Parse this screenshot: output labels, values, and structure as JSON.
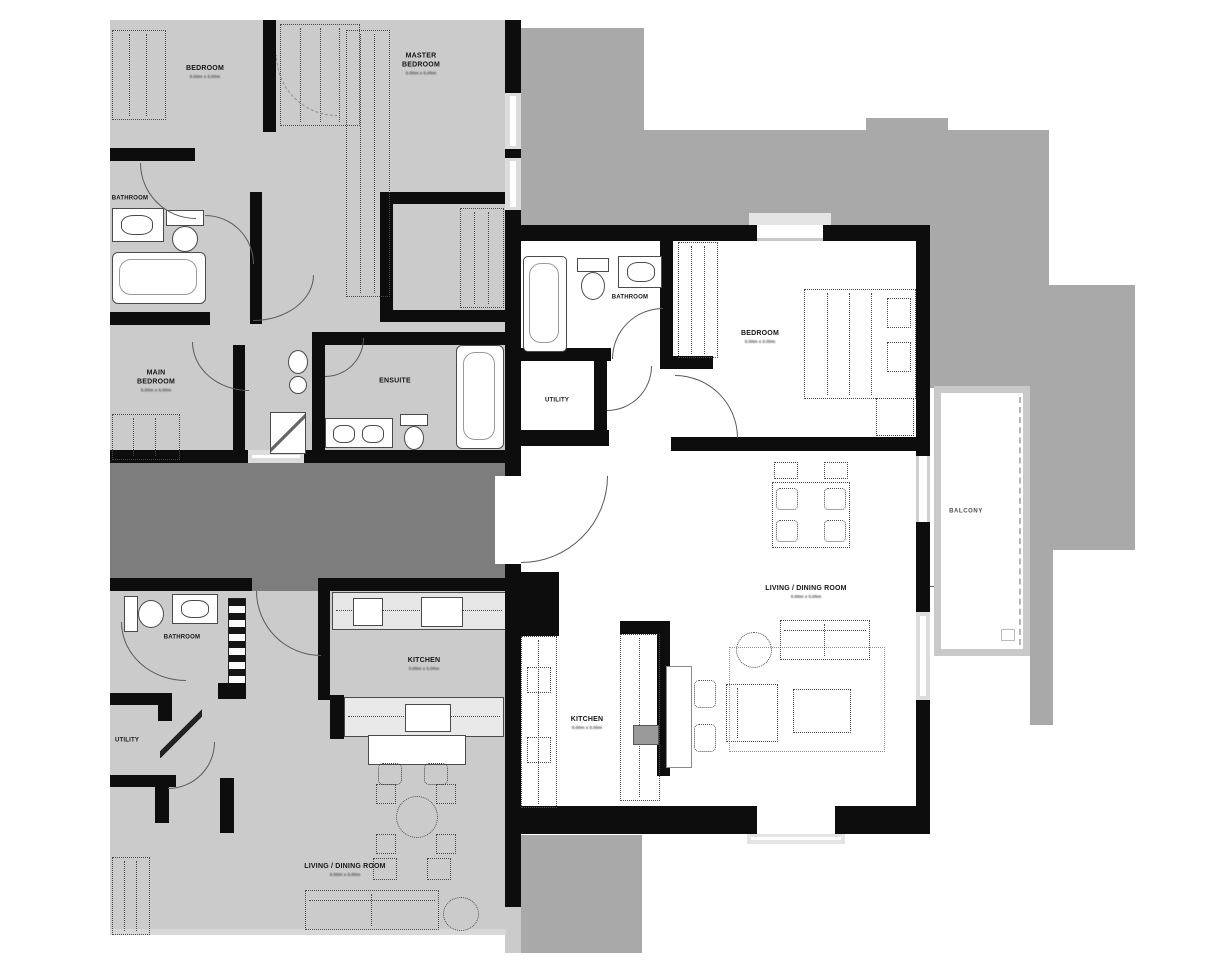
{
  "document": {
    "type": "architectural floor plan"
  },
  "palette": {
    "neighbor_floor_gray": "#cbcbcb",
    "corridor_gray": "#7d7d7d",
    "building_mass_gray": "#a9a9a9",
    "wall_black": "#0d0d0d",
    "featured_floor_white": "#ffffff",
    "window_gray": "#dcdcdc",
    "furniture_line_gray": "#4a4a4a"
  },
  "units": {
    "upper_left": {
      "name": "neighboring unit upper left (grayed out)",
      "rooms": {
        "bedroom": {
          "label": "BEDROOM",
          "dims": "0.00m x 0.00m"
        },
        "master_bedroom": {
          "label": "MASTER BEDROOM",
          "dims": "0.00m x 0.00m"
        },
        "bathroom": {
          "label": "BATHROOM"
        },
        "main_bedroom": {
          "label": "MAIN BEDROOM",
          "dims": "0.00m x 0.00m"
        },
        "ensuite": {
          "label": "ENSUITE"
        }
      }
    },
    "lower_left": {
      "name": "neighboring unit lower left (grayed out)",
      "rooms": {
        "bathroom": {
          "label": "BATHROOM"
        },
        "kitchen": {
          "label": "KITCHEN",
          "dims": "0.00m x 0.00m"
        },
        "utility": {
          "label": "UTILITY"
        },
        "living_dining": {
          "label": "LIVING / DINING ROOM",
          "dims": "0.00m x 0.00m"
        }
      }
    },
    "featured": {
      "name": "featured unit (highlighted white)",
      "rooms": {
        "bathroom": {
          "label": "BATHROOM"
        },
        "bedroom": {
          "label": "BEDROOM",
          "dims": "0.00m x 0.00m"
        },
        "utility": {
          "label": "UTILITY"
        },
        "living_dining": {
          "label": "LIVING / DINING ROOM",
          "dims": "0.00m x 0.00m"
        },
        "kitchen": {
          "label": "KITCHEN",
          "dims": "0.00m x 0.00m"
        },
        "balcony": {
          "label": "BALCONY"
        }
      }
    }
  }
}
